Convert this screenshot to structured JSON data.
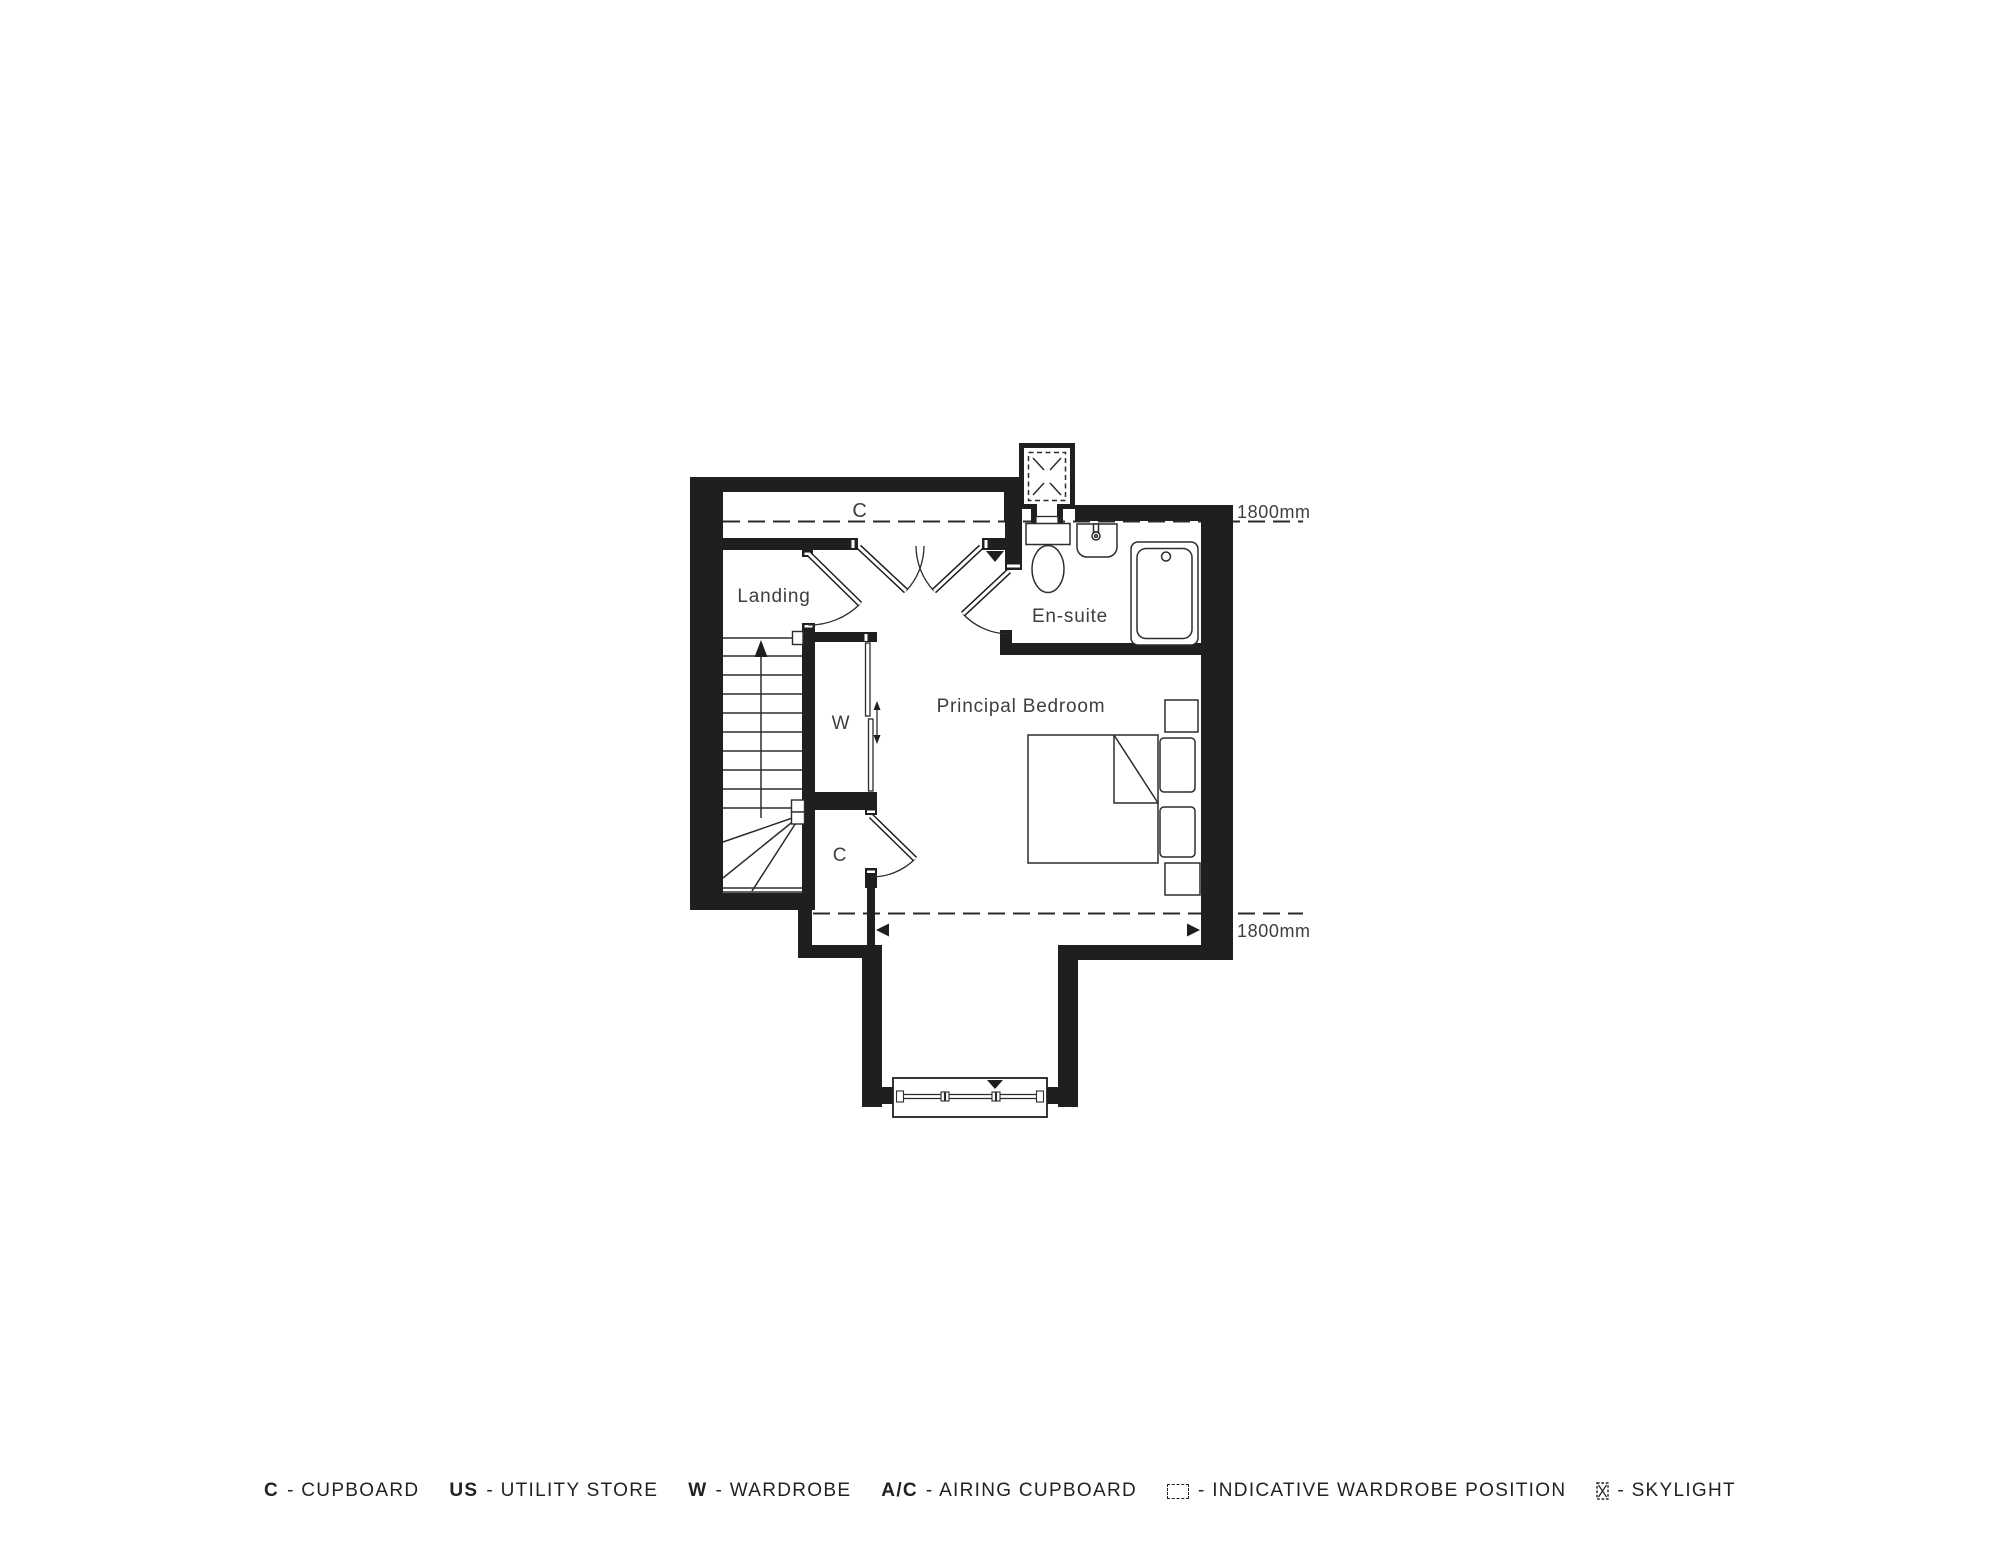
{
  "plan": {
    "labels": {
      "cupboard_top": "C",
      "landing": "Landing",
      "ensuite": "En-suite",
      "bedroom": "Principal Bedroom",
      "wardrobe": "W",
      "cupboard_bottom": "C"
    },
    "dimensions": {
      "top": "1800mm",
      "bottom": "1800mm"
    }
  },
  "legend": {
    "items": [
      {
        "abbr": "C",
        "label": "- CUPBOARD"
      },
      {
        "abbr": "US",
        "label": "- UTILITY STORE"
      },
      {
        "abbr": "W",
        "label": "- WARDROBE"
      },
      {
        "abbr": "A/C",
        "label": "- AIRING CUPBOARD"
      },
      {
        "icon": "wardrobe-position-icon",
        "label": "- INDICATIVE WARDROBE POSITION"
      },
      {
        "icon": "skylight-icon",
        "label": "- SKYLIGHT"
      }
    ]
  },
  "colors": {
    "wall": "#211e1f",
    "line": "#2e2b2c",
    "text": "#3f3d3e",
    "background": "#ffffff"
  }
}
